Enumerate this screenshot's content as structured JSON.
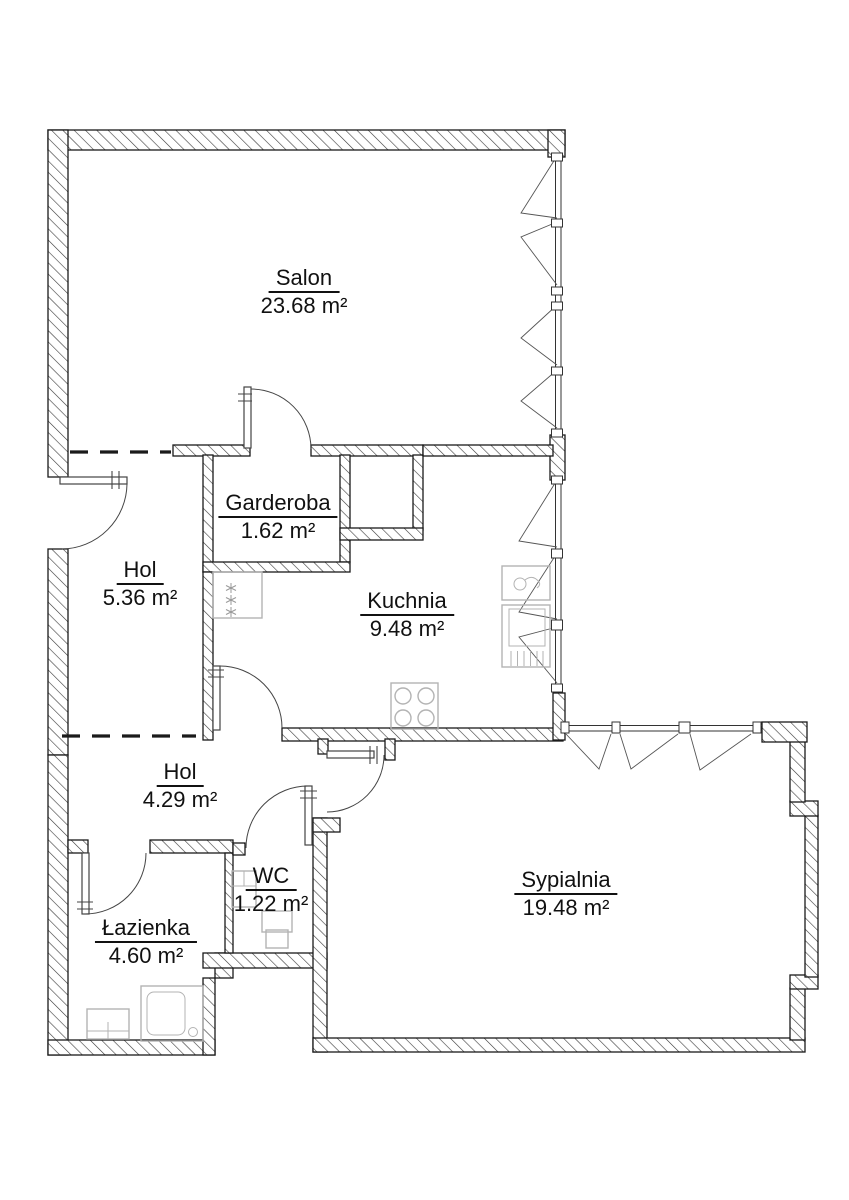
{
  "rooms": [
    {
      "id": "salon",
      "name": "Salon",
      "area": "23.68 m²"
    },
    {
      "id": "garderoba",
      "name": "Garderoba",
      "area": "1.62 m²"
    },
    {
      "id": "hol-upper",
      "name": "Hol",
      "area": "5.36 m²"
    },
    {
      "id": "kuchnia",
      "name": "Kuchnia",
      "area": "9.48 m²"
    },
    {
      "id": "hol-lower",
      "name": "Hol",
      "area": "4.29 m²"
    },
    {
      "id": "wc",
      "name": "WC",
      "area": "1.22 m²"
    },
    {
      "id": "lazienka",
      "name": "Łazienka",
      "area": "4.60 m²"
    },
    {
      "id": "sypialnia",
      "name": "Sypialnia",
      "area": "19.48 m²"
    }
  ],
  "colors": {
    "background": "#ffffff",
    "wall_outline": "#1a1a1a",
    "hatch_line": "#3a3a3a",
    "fixture_gray": "#b3b3b3",
    "text": "#111111"
  }
}
